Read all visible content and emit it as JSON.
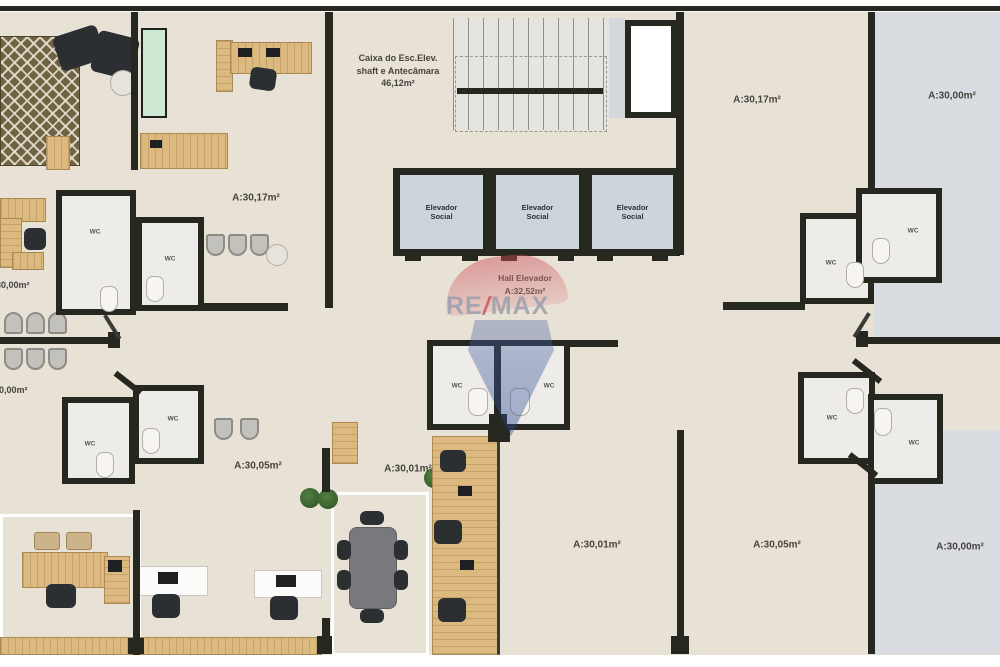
{
  "shaft": {
    "line1": "Caixa do Esc.Elev.",
    "line2": "shaft e Antecâmara",
    "line3": "46,12m²"
  },
  "elevators": {
    "line1": "Elevador",
    "line2": "Social"
  },
  "hall": {
    "title": "Hall Elevador",
    "area": "A:32,52m²"
  },
  "labels": {
    "wc": "WC"
  },
  "rooms": {
    "left_upper": "A:30,17m²",
    "left_edge_upper": "30,00m²",
    "left_edge_lower": "30,00m²",
    "left_lower": "A:30,05m²",
    "center_lower": "A:30,01m²",
    "top_right_inner": "A:30,17m²",
    "top_right_outer": "A:30,00m²",
    "bottom_center": "A:30,01m²",
    "bottom_right_inner": "A:30,05m²",
    "bottom_right_outer": "A:30,00m²"
  },
  "watermark": {
    "re": "RE",
    "slash": "/",
    "max": "MAX"
  },
  "colors": {
    "wall": "#26271f",
    "floor": "#e8e1d5",
    "floor_cool": "#d9dce1",
    "wood": "#dcb97e",
    "elevator_cab": "#ccd5da",
    "remax_red": "#c84a52",
    "remax_blue": "#3d5fa0",
    "cabinet_green": "#cde9d4"
  }
}
